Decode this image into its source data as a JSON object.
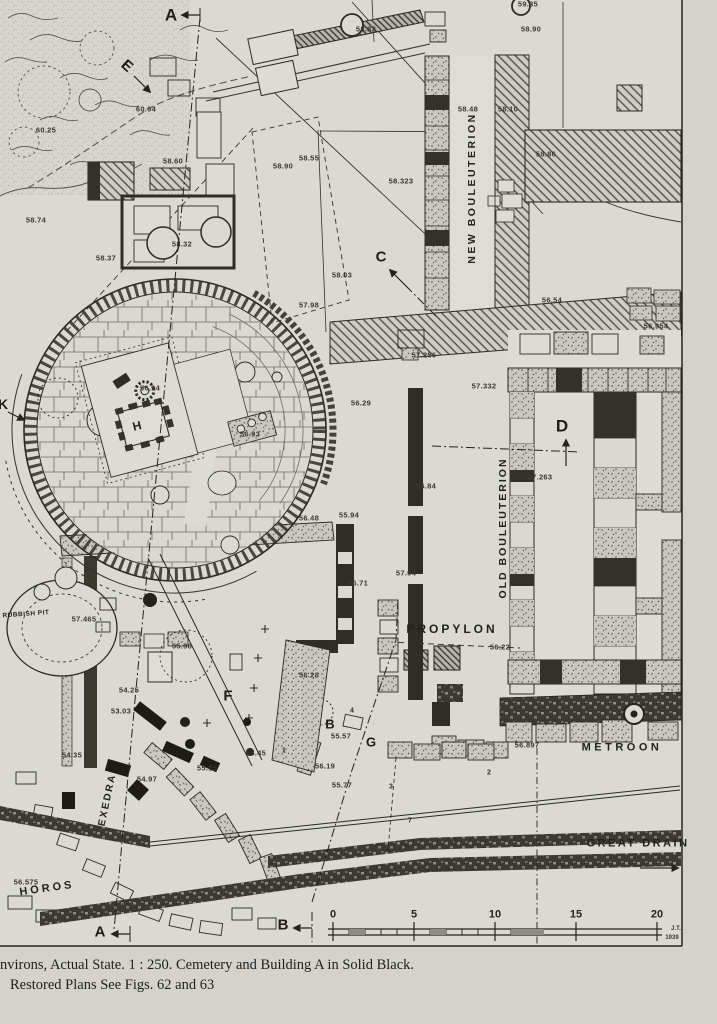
{
  "page": {
    "caption_line1": "nvirons, Actual State.  1 : 250.  Cemetery and Building A in Solid Black.",
    "caption_line2": "Restored Plans See Figs. 62 and 63",
    "signature_initials": "J.T.",
    "signature_year": "1939"
  },
  "map": {
    "building_labels": [
      {
        "t": "NEW BOULEUTERION",
        "x": 472,
        "y": 188,
        "r": -90,
        "s": 10.5,
        "ls": 2.5
      },
      {
        "t": "OLD BOULEUTERION",
        "x": 503,
        "y": 528,
        "r": -90,
        "s": 10.5,
        "ls": 2
      },
      {
        "t": "PROPYLON",
        "x": 452,
        "y": 629,
        "r": 0,
        "s": 12,
        "ls": 3
      },
      {
        "t": "METROON",
        "x": 622,
        "y": 748,
        "r": 0,
        "s": 11,
        "ls": 3.5
      },
      {
        "t": "GREAT DRAIN",
        "x": 638,
        "y": 844,
        "r": 0,
        "s": 11,
        "ls": 2.5
      },
      {
        "t": "EXEDRA",
        "x": 108,
        "y": 800,
        "r": -78,
        "s": 10,
        "ls": 2
      },
      {
        "t": "HOROS",
        "x": 47,
        "y": 889,
        "r": -8,
        "s": 11,
        "ls": 3
      },
      {
        "t": "RUBBISH PIT",
        "x": 26,
        "y": 615,
        "r": -4,
        "s": 6.5,
        "ls": 0.5
      }
    ],
    "section_markers": [
      {
        "t": "A",
        "x": 171,
        "y": 15,
        "r": 0,
        "s": 17
      },
      {
        "t": "E",
        "x": 127,
        "y": 66,
        "r": 42,
        "s": 15
      },
      {
        "t": "C",
        "x": 381,
        "y": 257,
        "r": 0,
        "s": 15
      },
      {
        "t": "D",
        "x": 562,
        "y": 426,
        "r": 0,
        "s": 17
      },
      {
        "t": "H",
        "x": 137,
        "y": 426,
        "r": -14,
        "s": 12
      },
      {
        "t": "F",
        "x": 228,
        "y": 696,
        "r": 0,
        "s": 15
      },
      {
        "t": "G",
        "x": 371,
        "y": 742,
        "r": 0,
        "s": 13
      },
      {
        "t": "B",
        "x": 330,
        "y": 724,
        "r": 0,
        "s": 13
      },
      {
        "t": "K",
        "x": 3,
        "y": 404,
        "r": 0,
        "s": 14
      },
      {
        "t": "A",
        "x": 100,
        "y": 932,
        "r": 0,
        "s": 15
      },
      {
        "t": "B",
        "x": 283,
        "y": 925,
        "r": 0,
        "s": 15
      }
    ],
    "elevations": [
      {
        "t": "59.35",
        "x": 528,
        "y": 4
      },
      {
        "t": "58.90",
        "x": 531,
        "y": 29
      },
      {
        "t": "58.82",
        "x": 366,
        "y": 29
      },
      {
        "t": "58.48",
        "x": 468,
        "y": 109
      },
      {
        "t": "58.10",
        "x": 508,
        "y": 109
      },
      {
        "t": "58.86",
        "x": 546,
        "y": 154
      },
      {
        "t": "58.55",
        "x": 309,
        "y": 158
      },
      {
        "t": "58.90",
        "x": 283,
        "y": 166
      },
      {
        "t": "58.323",
        "x": 401,
        "y": 181
      },
      {
        "t": "60.64",
        "x": 146,
        "y": 109
      },
      {
        "t": "60.25",
        "x": 46,
        "y": 130
      },
      {
        "t": "58.74",
        "x": 36,
        "y": 220
      },
      {
        "t": "58.60",
        "x": 173,
        "y": 161
      },
      {
        "t": "58.37",
        "x": 106,
        "y": 258
      },
      {
        "t": "58.32",
        "x": 182,
        "y": 244
      },
      {
        "t": "58.03",
        "x": 342,
        "y": 275
      },
      {
        "t": "57.98",
        "x": 309,
        "y": 305
      },
      {
        "t": "57.256",
        "x": 424,
        "y": 355
      },
      {
        "t": "56.54",
        "x": 552,
        "y": 300
      },
      {
        "t": "56.954",
        "x": 656,
        "y": 326
      },
      {
        "t": "57.332",
        "x": 484,
        "y": 386
      },
      {
        "t": "57.263",
        "x": 540,
        "y": 477
      },
      {
        "t": "56.94",
        "x": 150,
        "y": 388
      },
      {
        "t": "56.93",
        "x": 250,
        "y": 434
      },
      {
        "t": "56.29",
        "x": 361,
        "y": 403
      },
      {
        "t": "56.84",
        "x": 426,
        "y": 486
      },
      {
        "t": "55.94",
        "x": 349,
        "y": 515
      },
      {
        "t": "57.04",
        "x": 406,
        "y": 573
      },
      {
        "t": "56.71",
        "x": 358,
        "y": 583
      },
      {
        "t": "56.48",
        "x": 309,
        "y": 518
      },
      {
        "t": "57.465",
        "x": 84,
        "y": 619
      },
      {
        "t": "55.98",
        "x": 182,
        "y": 646
      },
      {
        "t": "56.28",
        "x": 309,
        "y": 675
      },
      {
        "t": "54.25",
        "x": 129,
        "y": 690
      },
      {
        "t": "53.03",
        "x": 121,
        "y": 711
      },
      {
        "t": "56.22",
        "x": 500,
        "y": 647
      },
      {
        "t": "56.897",
        "x": 527,
        "y": 745
      },
      {
        "t": "55.57",
        "x": 341,
        "y": 736
      },
      {
        "t": "55.45",
        "x": 256,
        "y": 753
      },
      {
        "t": "55.15",
        "x": 207,
        "y": 768
      },
      {
        "t": "56.19",
        "x": 325,
        "y": 766
      },
      {
        "t": "55.77",
        "x": 342,
        "y": 785
      },
      {
        "t": "54.97",
        "x": 147,
        "y": 779
      },
      {
        "t": "54.35",
        "x": 72,
        "y": 755
      },
      {
        "t": "56.575",
        "x": 26,
        "y": 882
      },
      {
        "t": "55.40",
        "x": 116,
        "y": 905
      },
      {
        "t": "54.59",
        "x": 438,
        "y": 869
      }
    ],
    "trench_numbers": [
      {
        "t": "1",
        "x": 284,
        "y": 751
      },
      {
        "t": "4",
        "x": 352,
        "y": 711
      },
      {
        "t": "3",
        "x": 391,
        "y": 787
      },
      {
        "t": "7",
        "x": 410,
        "y": 821
      },
      {
        "t": "2",
        "x": 489,
        "y": 773
      },
      {
        "t": "6",
        "x": 456,
        "y": 842
      },
      {
        "t": "5",
        "x": 406,
        "y": 848
      }
    ],
    "scale_bar": {
      "ticks": [
        {
          "t": "0",
          "x": 333
        },
        {
          "t": "5",
          "x": 414
        },
        {
          "t": "10",
          "x": 495
        },
        {
          "t": "15",
          "x": 576
        },
        {
          "t": "20",
          "x": 657
        }
      ]
    }
  }
}
